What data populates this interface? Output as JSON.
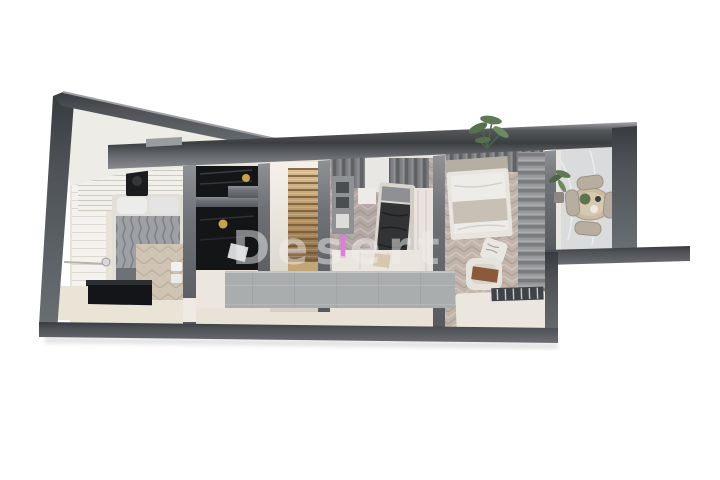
{
  "watermark": {
    "text": "Desert"
  },
  "palette": {
    "background": "#ffffff",
    "wall_dark": "#3a3d41",
    "wall_mid": "#5f6468",
    "wall_light": "#8f9396",
    "floor_cream": "#e9e3d7",
    "herringbone_mauve": "#b3a8a4",
    "herringbone_beige": "#c0b4ab",
    "marble_grey": "#dadbdd",
    "stair_wood": "#b3905f",
    "closet_black": "#141517",
    "concrete_grey": "#a9adad",
    "led_pink": "#e07ce0",
    "lamp_gold": "#c9a24a",
    "plant_green": "#55724c",
    "throw_brown": "#8a5a3a"
  }
}
